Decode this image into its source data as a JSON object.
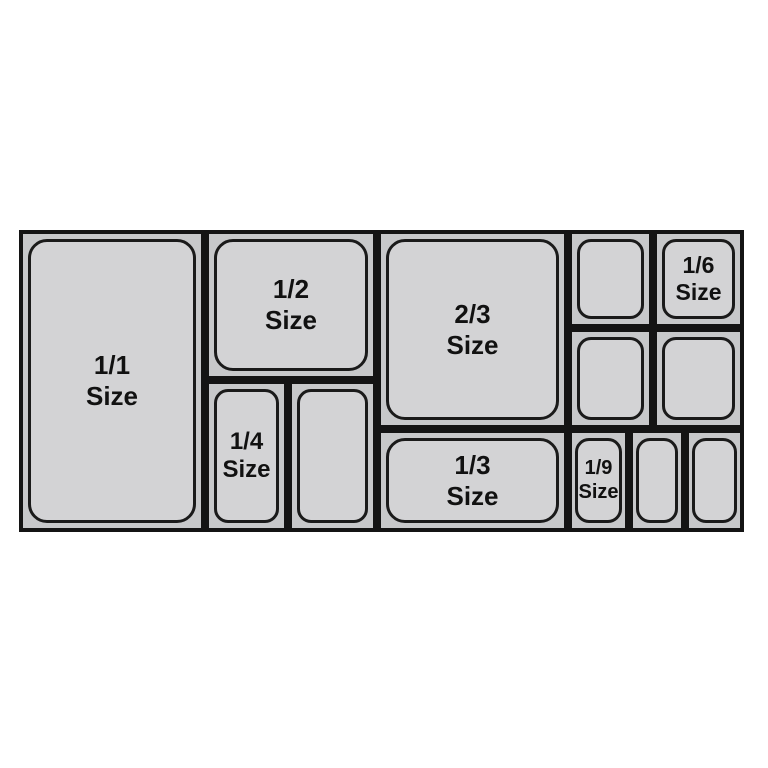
{
  "diagram_title": "Gastronorm pan size layout",
  "colors": {
    "background": "#ffffff",
    "tray_fill": "#c7c8ca",
    "pan_fill": "#d3d3d5",
    "border": "#141414",
    "text": "#111111"
  },
  "pans": {
    "full": {
      "line1": "1/1",
      "line2": "Size"
    },
    "half": {
      "line1": "1/2",
      "line2": "Size"
    },
    "quarter": {
      "line1": "1/4",
      "line2": "Size"
    },
    "two_thirds": {
      "line1": "2/3",
      "line2": "Size"
    },
    "third": {
      "line1": "1/3",
      "line2": "Size"
    },
    "sixth": {
      "line1": "1/6",
      "line2": "Size"
    },
    "ninth": {
      "line1": "1/9",
      "line2": "Size"
    }
  }
}
